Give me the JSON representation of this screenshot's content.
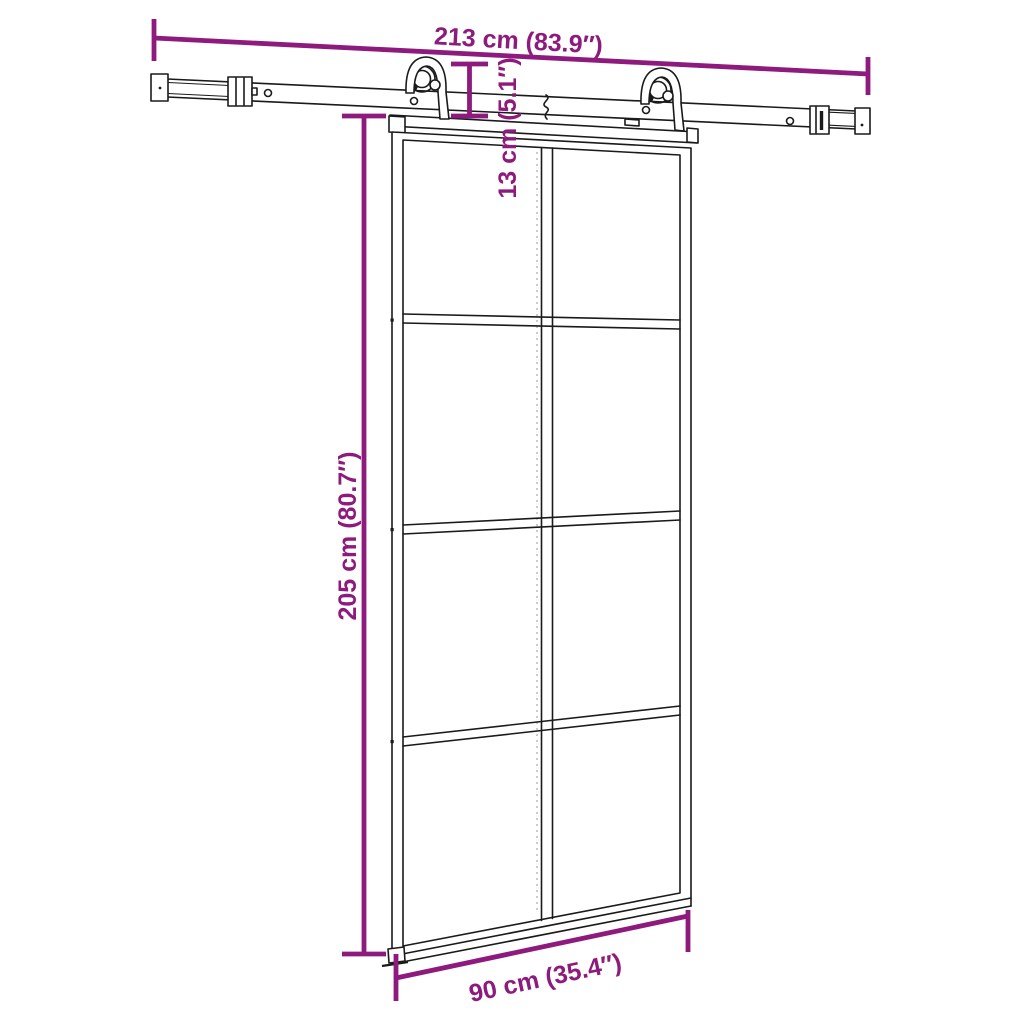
{
  "diagram": {
    "kind": "sliding-barn-door-with-rail-hardware-dimension-diagram",
    "dimensions": {
      "rail_length": {
        "label": "213 cm (83.9″)",
        "cm": 213,
        "inches": 83.9
      },
      "door_height": {
        "label": "205 cm (80.7″)",
        "cm": 205,
        "inches": 80.7
      },
      "door_width": {
        "label": "90 cm (35.4″)",
        "cm": 90,
        "inches": 35.4
      },
      "hardware_height": {
        "label": "13 cm (5.1″)",
        "cm": 13,
        "inches": 5.1
      }
    },
    "door": {
      "glass_panes": 8,
      "pane_columns": 2,
      "pane_rows": 4,
      "rollers": 2
    },
    "colors": {
      "dimension": "#8d1a7c",
      "line": "#1a1a1a",
      "background": "#ffffff"
    }
  }
}
